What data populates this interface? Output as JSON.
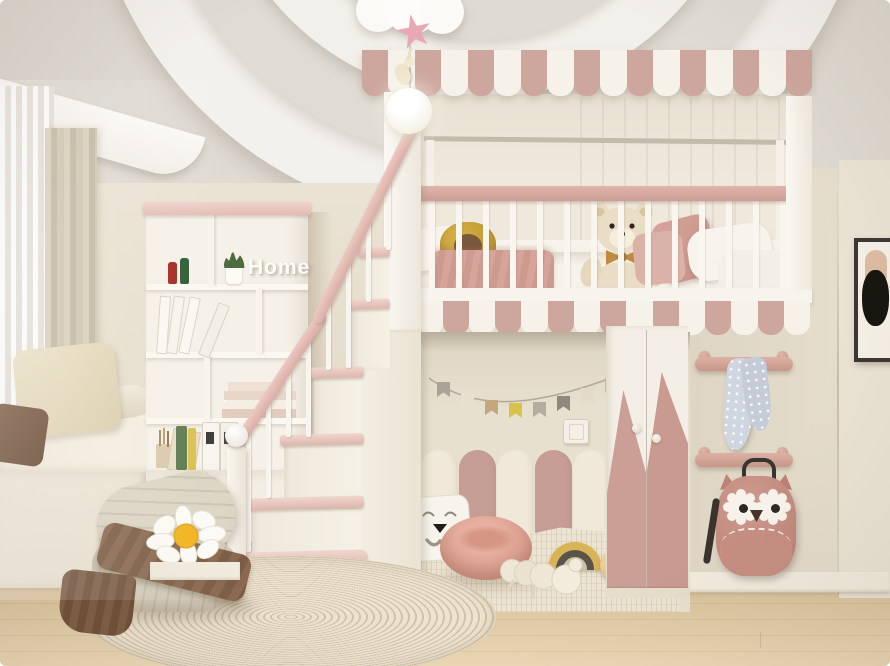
{
  "meta": {
    "title": "Children's bedroom interior render with loft bed",
    "style": "cream and dusty-pink kids room, 3D visualization"
  },
  "decor": {
    "home_sign": "Home"
  },
  "palette": {
    "wall": "#e7dfd0",
    "wall_right": "#e0d8c8",
    "ceiling": "#dedad2",
    "ceiling_ring": "#f3f1ed",
    "awning_pink": "#cda69e",
    "awning_white": "#f6f2ea",
    "rail_pink": "#d8aca4",
    "arch_cream": "#f0e9da",
    "arch_pink": "#c79e95",
    "floor_wood": "#e0cba6",
    "rug_base": "#ece3d0",
    "rug_stripe": "#d2c3a8",
    "throw_brown": "#8a6950",
    "beanbag": "#d8d1c0",
    "towel_blue": "#cfd6df",
    "backpack_pink": "#c78f84",
    "daisy_center": "#f2b31f",
    "teddy_fur": "#e9ddc6"
  },
  "objects": [
    "cloud pendant lamp with pink star and glowing ball",
    "recessed circular ceiling design",
    "loft bed with scalloped awning and valance",
    "white crib-style railing with pink top rail",
    "teddy bear, sunflower plush and pillows on loft mattress",
    "staircase with pink treads and ball-finial newel post",
    "cubby bookshelf with Home sign, books, binders and plant",
    "storage cabinet with brass handles",
    "window seat with linen pillows and sheer curtains",
    "play nook with pennant bunting, wall switch and arch panels",
    "cat-face pillow, pink pouf, rainbow stacker, ball and plush toy",
    "wardrobe with pink mountain doors and round knobs",
    "peg rails holding polka-dot towel and owl backpack",
    "framed abstract art on right wall",
    "beanbag lounger with daisy pillow and brown throw",
    "striped oval rug on wood floor"
  ]
}
